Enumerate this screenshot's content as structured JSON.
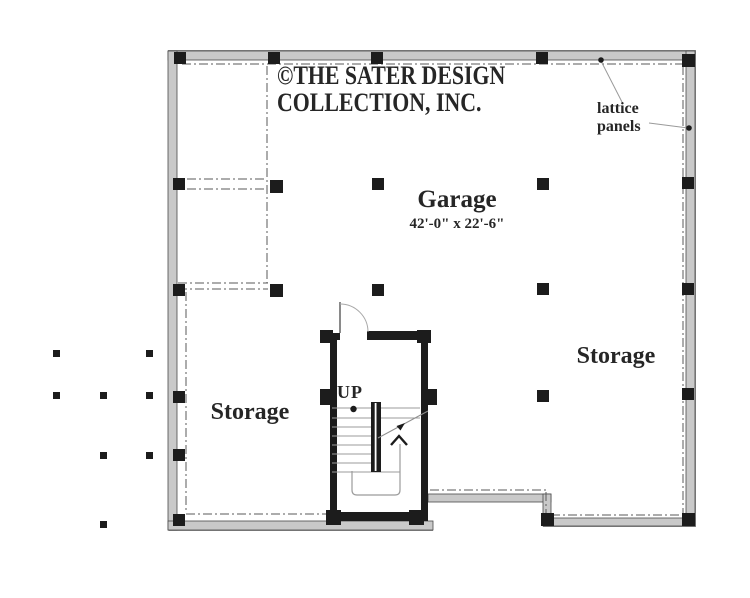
{
  "document": {
    "type": "first-floor / garage level floor plan",
    "branding": {
      "line1": "©THE SATER DESIGN",
      "line2": "COLLECTION, INC."
    }
  },
  "rooms": {
    "garage": {
      "name": "Garage",
      "dims": "42'-0\" x 22'-6\""
    },
    "storage_left": {
      "name": "Storage"
    },
    "storage_right": {
      "name": "Storage"
    },
    "stairs": {
      "direction_label": "UP"
    }
  },
  "annotations": {
    "lattice_note": {
      "line1": "lattice",
      "line2": "panels"
    }
  },
  "colors": {
    "ink": "#1c1c1c",
    "wall_fill": "#c9c9c9",
    "wall_edge": "#4a4a4a",
    "dash": "#5a5a5a",
    "tread": "#9b9b9b",
    "text": "#262626",
    "background": "#ffffff"
  }
}
